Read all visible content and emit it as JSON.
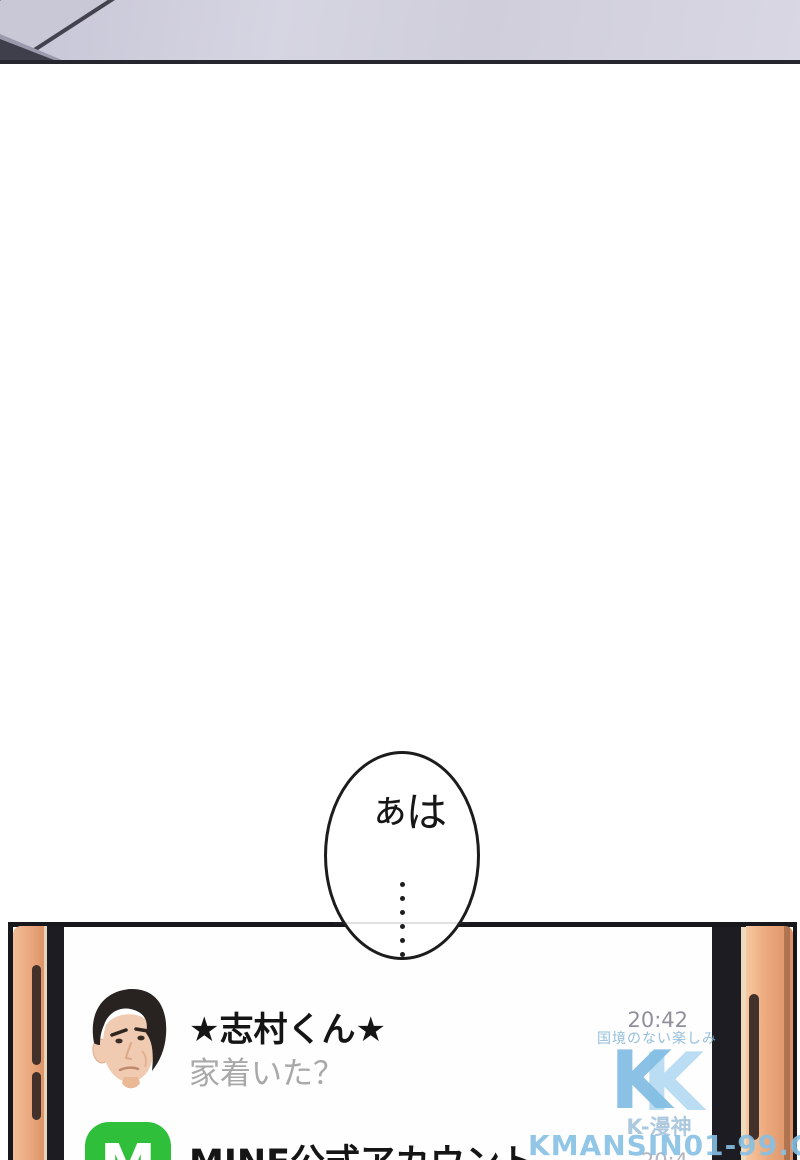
{
  "bubble": {
    "sigh": "はぁ",
    "dot_count": 6
  },
  "chat": {
    "rows": [
      {
        "name": "★志村くん★",
        "preview": "家着いた？",
        "time": "20:42"
      },
      {
        "name": "MINE公式アカウント",
        "time": "20:4",
        "icon_letter": "M"
      }
    ]
  },
  "watermark": {
    "slogan": "国境のない楽しみ",
    "logo_letter": "K",
    "site_name": "K-漫神",
    "url": "KMANSIN01-99.COM"
  },
  "colors": {
    "accent-green": "#2fbf3a",
    "phone-copper": "#eca87c",
    "watermark-blue": "#86c0e4",
    "panel-lavender": "#d6d5e2"
  }
}
